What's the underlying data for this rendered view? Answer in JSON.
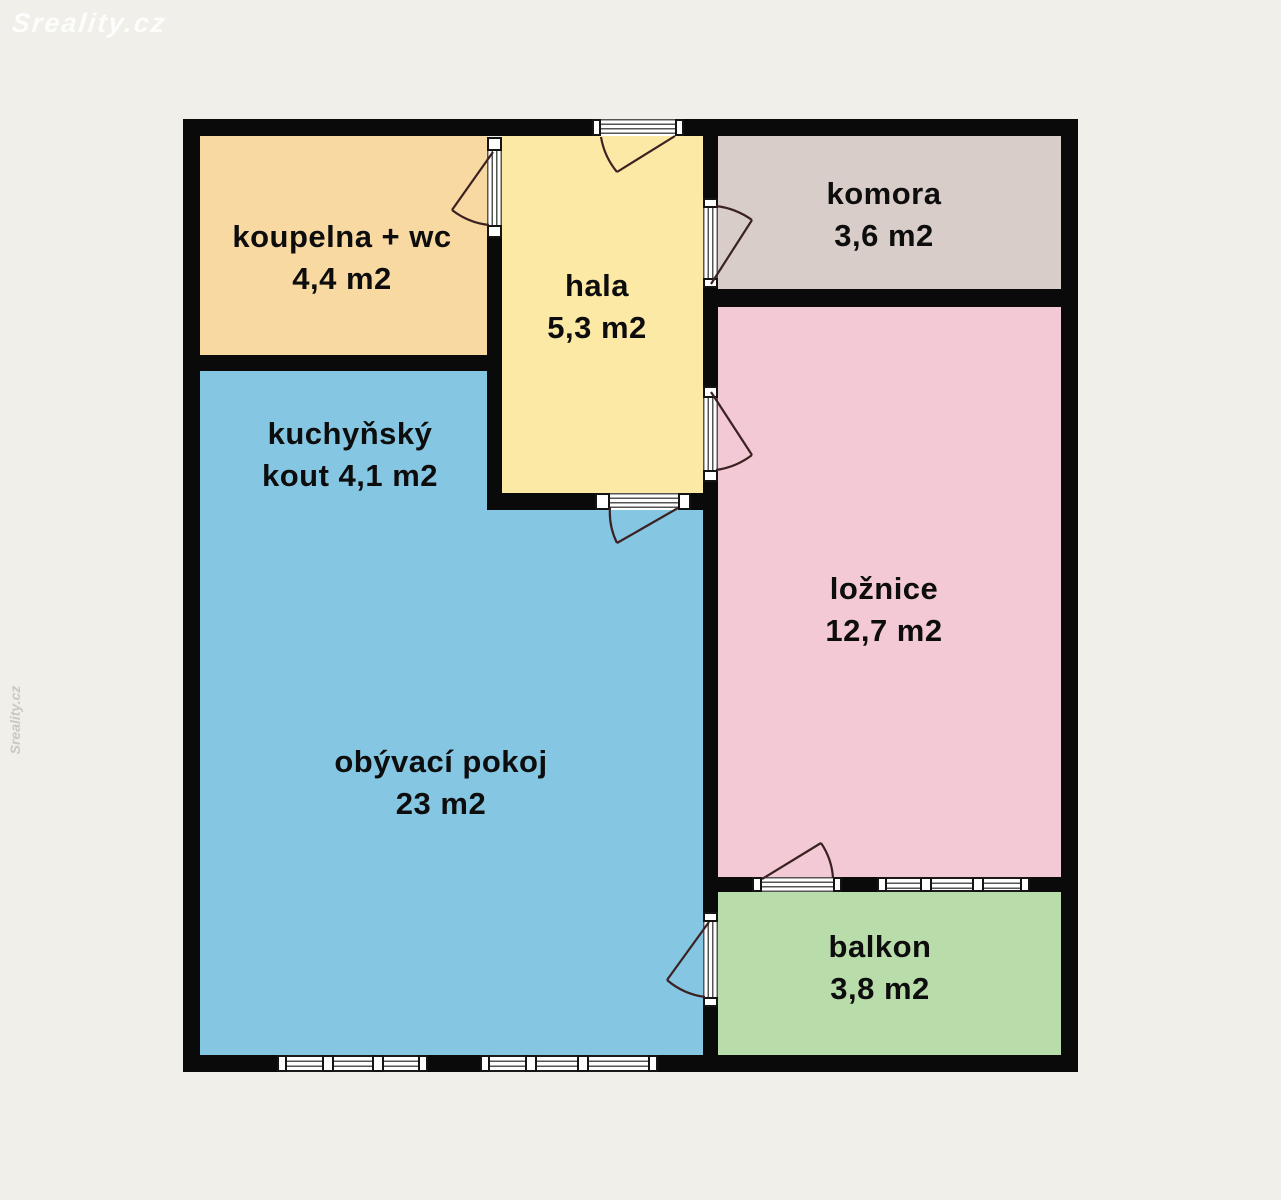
{
  "watermark": {
    "logo_text": "Sreality.cz",
    "side_text": "Sreality.cz"
  },
  "palette": {
    "background": "#f0efea",
    "wall": "#0a0a0a",
    "door_arc": "#3b2222",
    "symbol_line": "#555555"
  },
  "rooms": [
    {
      "name": "koupelna + wc",
      "area": "4,4 m2",
      "color": "#f8d9a2",
      "label_lines": [
        "koupelna + wc",
        "4,4 m2"
      ]
    },
    {
      "name": "hala",
      "area": "5,3 m2",
      "color": "#fce9a6",
      "label_lines": [
        "hala",
        "5,3 m2"
      ]
    },
    {
      "name": "komora",
      "area": "3,6 m2",
      "color": "#d9cdc9",
      "label_lines": [
        "komora",
        "3,6 m2"
      ]
    },
    {
      "name": "kuchyňský kout",
      "area": "4,1 m2",
      "color": "#85c6e2",
      "label_lines": [
        "kuchyňský",
        "kout 4,1 m2"
      ]
    },
    {
      "name": "ložnice",
      "area": "12,7 m2",
      "color": "#f2c9d4",
      "label_lines": [
        "ložnice",
        "12,7 m2"
      ]
    },
    {
      "name": "obývací pokoj",
      "area": "23 m2",
      "color": "#85c6e2",
      "label_lines": [
        "obývací pokoj",
        "23 m2"
      ]
    },
    {
      "name": "balkon",
      "area": "3,8 m2",
      "color": "#b9dcab",
      "label_lines": [
        "balkon",
        "3,8 m2"
      ]
    }
  ]
}
